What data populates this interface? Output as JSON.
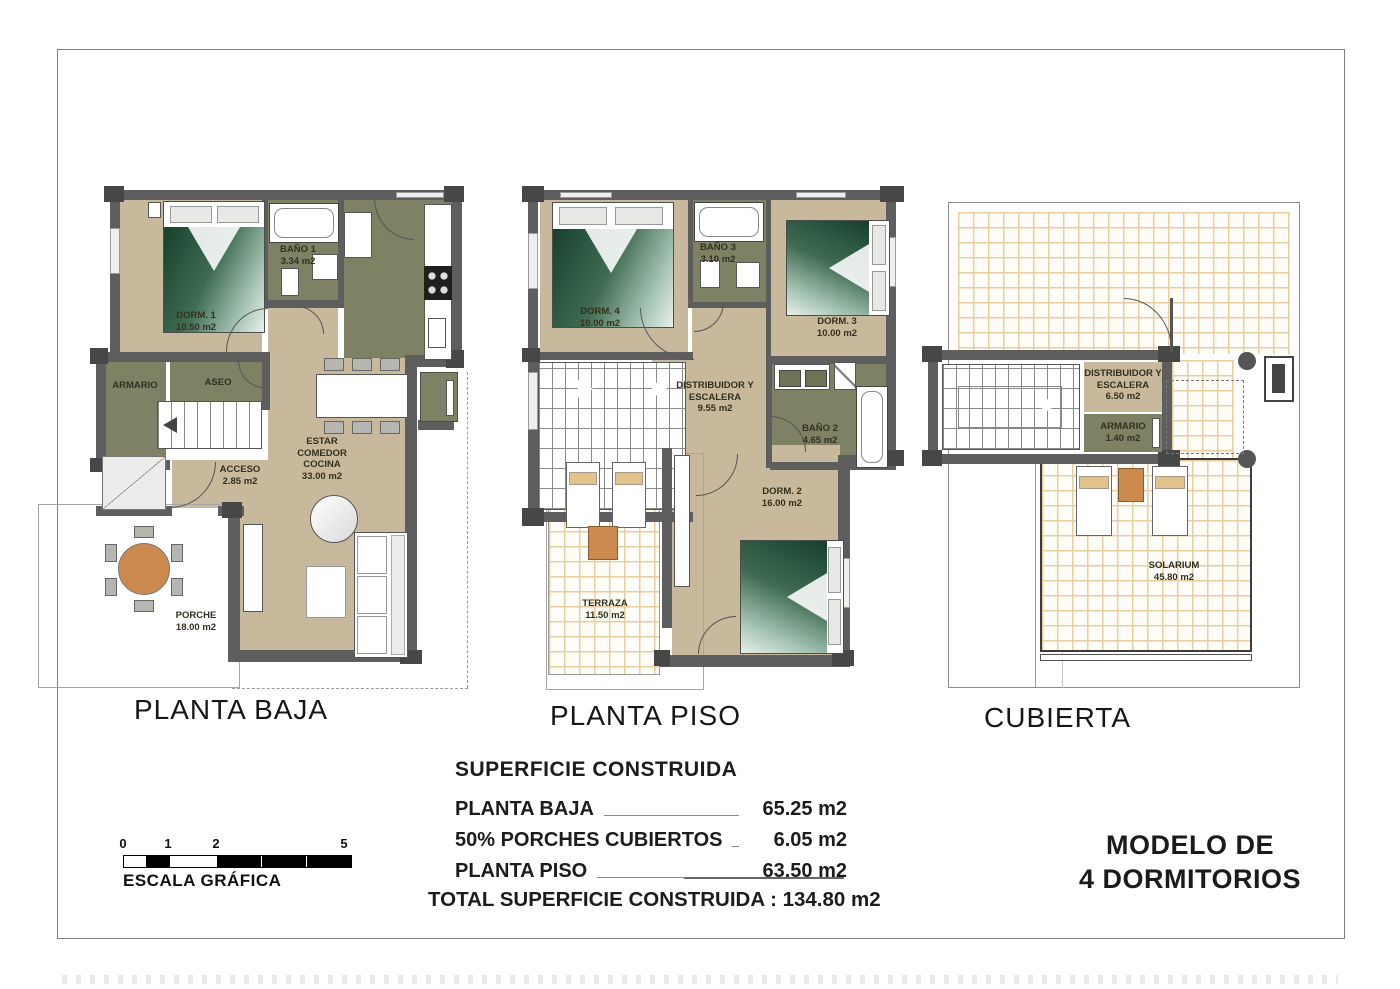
{
  "colors": {
    "wall": "#5e5e5e",
    "floor_tan": "#c8b89c",
    "floor_olive": "#7e8163",
    "tile_line": "#e9cda2",
    "accent_orange": "#cd8a4f",
    "bed_green": "#2c5843"
  },
  "plans": {
    "baja": {
      "title": "PLANTA BAJA",
      "rooms": {
        "dorm1": {
          "name": "DORM. 1",
          "area": "10.50 m2"
        },
        "bano1": {
          "name": "BAÑO 1",
          "area": "3.34 m2"
        },
        "armario": {
          "name": "ARMARIO"
        },
        "aseo": {
          "name": "ASEO"
        },
        "acceso": {
          "name": "ACCESO",
          "area": "2.85 m2"
        },
        "estar": {
          "name": "ESTAR COMEDOR COCINA",
          "area": "33.00 m2"
        },
        "porche": {
          "name": "PORCHE",
          "area": "18.00 m2"
        }
      }
    },
    "piso": {
      "title": "PLANTA PISO",
      "rooms": {
        "dorm4": {
          "name": "DORM. 4",
          "area": "10.00 m2"
        },
        "bano3": {
          "name": "BAÑO 3",
          "area": "3.10 m2"
        },
        "dorm3": {
          "name": "DORM. 3",
          "area": "10.00 m2"
        },
        "distrib": {
          "name": "DISTRIBUIDOR Y ESCALERA",
          "area": "9.55 m2"
        },
        "bano2": {
          "name": "BAÑO 2",
          "area": "4.65 m2"
        },
        "dorm2": {
          "name": "DORM. 2",
          "area": "16.00 m2"
        },
        "terraza": {
          "name": "TERRAZA",
          "area": "11.50 m2"
        }
      }
    },
    "cubierta": {
      "title": "CUBIERTA",
      "rooms": {
        "distrib": {
          "name": "DISTRIBUIDOR Y ESCALERA",
          "area": "6.50 m2"
        },
        "armario": {
          "name": "ARMARIO",
          "area": "1.40 m2"
        },
        "solarium": {
          "name": "SOLARIUM",
          "area": "45.80 m2"
        }
      }
    }
  },
  "summary": {
    "header": "SUPERFICIE CONSTRUIDA",
    "rows": [
      {
        "label": "PLANTA BAJA",
        "value": "65.25 m2"
      },
      {
        "label": "50% PORCHES CUBIERTOS",
        "value": "6.05 m2"
      },
      {
        "label": "PLANTA PISO",
        "value": "63.50 m2"
      }
    ],
    "total": "TOTAL SUPERFICIE CONSTRUIDA : 134.80 m2"
  },
  "scale": {
    "label": "ESCALA GRÁFICA",
    "ticks": [
      "0",
      "1",
      "2",
      "5"
    ]
  },
  "model": {
    "line1": "MODELO DE",
    "line2": "4 DORMITORIOS"
  }
}
